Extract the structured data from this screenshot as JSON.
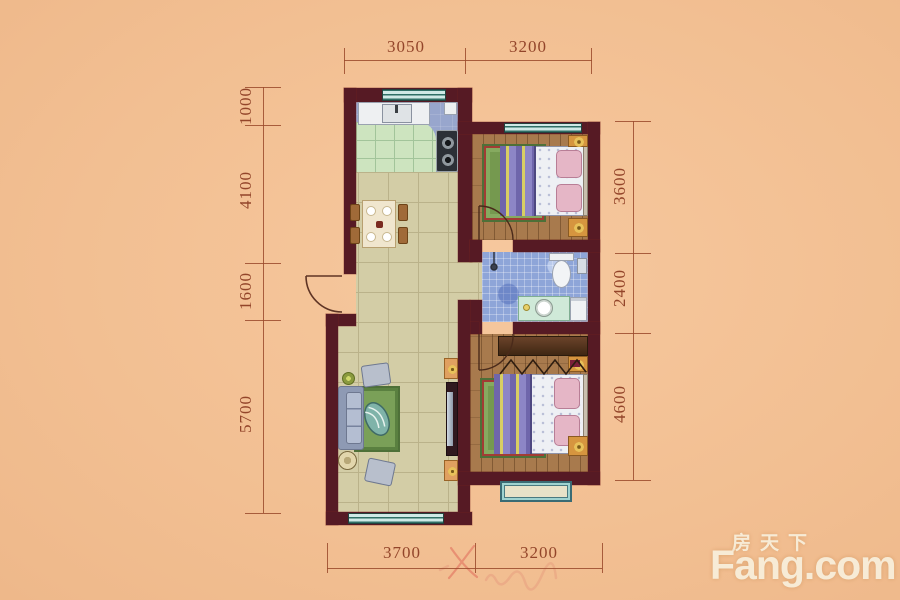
{
  "watermark": {
    "zh": "房天下",
    "en": "Fang.com"
  },
  "dimensions": {
    "top": [
      "3050",
      "3200"
    ],
    "bottom": [
      "3700",
      "3200"
    ],
    "left": [
      "1000",
      "4100",
      "1600",
      "5700"
    ],
    "right": [
      "3600",
      "2400",
      "4600"
    ]
  },
  "colors": {
    "background": "#f2bf92",
    "wall": "#561a24",
    "dimension_ink": "#9a4a2c",
    "living_floor": "#d3cda6",
    "wood_floor": "#a87a4d",
    "kitchen_floor": "#98a6cd",
    "kitchen_tile": "#cde4bf",
    "bath_tile": "#8ea5d8",
    "window_frame": "#2f6f66",
    "watermark_text": "#f8edd9"
  },
  "icons": {
    "stove": "stove-burners-icon",
    "sink": "kitchen-sink-icon",
    "toilet": "toilet-icon",
    "shower": "shower-icon",
    "annotation": "handwritten-x-mark"
  }
}
